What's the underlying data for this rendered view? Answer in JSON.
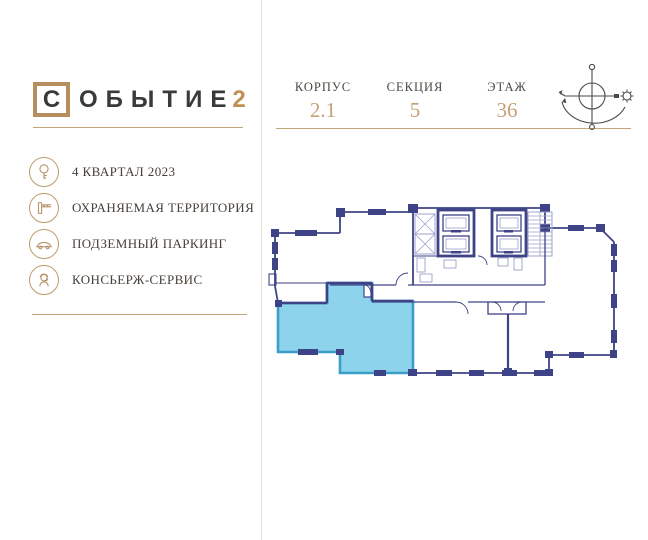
{
  "brand": {
    "boxed_letter": "С",
    "name_rest": "ОБЫТИЕ",
    "suffix": "2"
  },
  "header": {
    "fields": [
      {
        "label": "КОРПУС",
        "value": "2.1"
      },
      {
        "label": "СЕКЦИЯ",
        "value": "5"
      },
      {
        "label": "ЭТАЖ",
        "value": "36"
      }
    ],
    "compass_icon": "sun-orientation-compass"
  },
  "features": [
    {
      "icon": "key-icon",
      "label": "4 КВАРТАЛ 2023"
    },
    {
      "icon": "barrier-icon",
      "label": "ОХРАНЯЕМАЯ ТЕРРИТОРИЯ"
    },
    {
      "icon": "car-icon",
      "label": "ПОДЗЕМНЫЙ ПАРКИНГ"
    },
    {
      "icon": "concierge-icon",
      "label": "КОНСЬЕРЖ-СЕРВИС"
    }
  ],
  "floor_plan": {
    "description": "multi-unit floor plan, one apartment highlighted bottom-left",
    "highlight_fill": "#8ed3ec",
    "highlight_border": "#3a9ec9",
    "wall_color": "#3e4387"
  },
  "colors": {
    "gold": "#bd9a6d",
    "logo_number_gold": "#bf8f55",
    "text_dark": "#3a3a3a",
    "divider": "#e6e3de"
  }
}
